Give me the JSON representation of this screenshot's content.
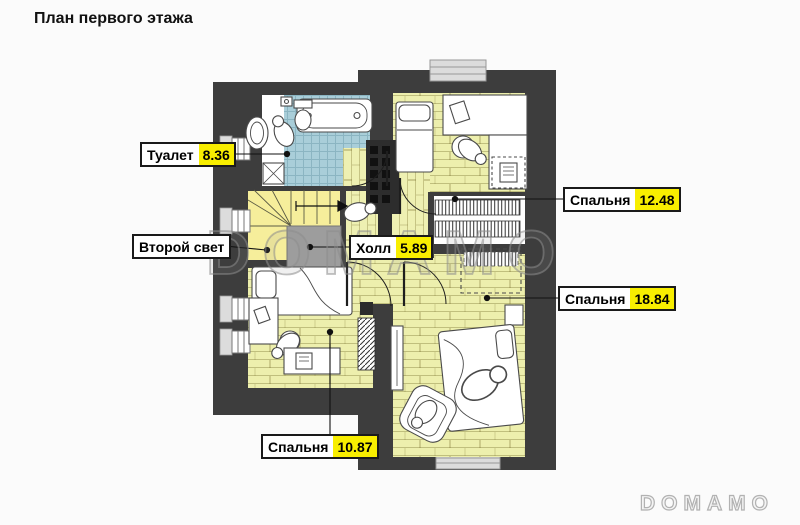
{
  "title": "План первого этажа",
  "watermark_text": "DOMAMO",
  "logo_text": "DOMAMO",
  "colors": {
    "wall": "#3d3d3d",
    "floor_wood": "#edefad",
    "floor_hall": "#eef0b2",
    "floor_stairs": "#f6ee9b",
    "floor_tile": "#a9ced9",
    "area_highlight": "#f8ee00",
    "void_gray": "#9d9d9d"
  },
  "rooms": [
    {
      "id": "toilet",
      "name": "Туалет",
      "area": "8.36"
    },
    {
      "id": "bedroom-top",
      "name": "Спальня",
      "area": "12.48"
    },
    {
      "id": "second-light",
      "name": "Второй свет",
      "area": ""
    },
    {
      "id": "hall",
      "name": "Холл",
      "area": "5.89"
    },
    {
      "id": "bedroom-right",
      "name": "Спальня",
      "area": "18.84"
    },
    {
      "id": "bedroom-bottom",
      "name": "Спальня",
      "area": "10.87"
    }
  ]
}
